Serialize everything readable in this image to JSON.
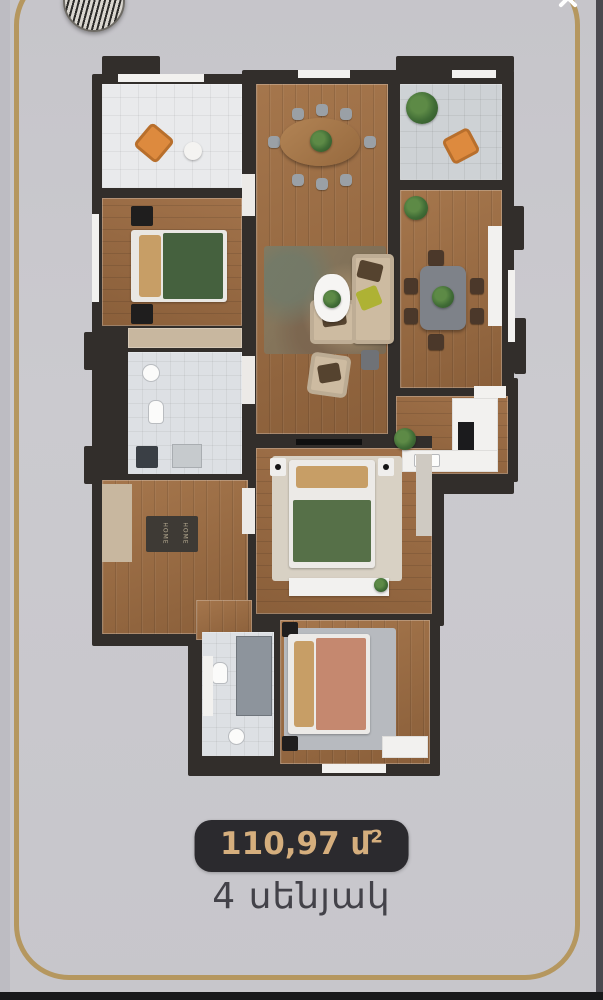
{
  "palette": {
    "bg": "#c9c8cd",
    "bg-edge": "#bdbcc2",
    "frame-gold": "#b5975f",
    "edge-dark": "#4a494f",
    "bottom-bar": "#18181a",
    "wall": "#322e2b",
    "wood": "#9c6e45",
    "tile": "#e9eaec",
    "tile-gray": "#ced2d5",
    "bath-tile": "#dde0e4",
    "accent-orange": "#dd8a3e",
    "bed-green": "#45613e",
    "bed-green2": "#567048",
    "bed-salmon": "#c5886f",
    "pillow-tan": "#c79e66",
    "sofa-beige": "#cdbba1",
    "pillow-brown": "#55432f",
    "pillow-lime": "#aeb234",
    "table-gray": "#7e8289",
    "chair-dark": "#4b382a",
    "chair-gray": "#9aa0a6",
    "rug-light": "#d8d1c4",
    "rug-gray": "#b7babf",
    "wardrobe-tan": "#c8b79f",
    "plant-green": "#3f6b35",
    "badge-bg": "#2b2a2e",
    "badge-text": "#d5ae7d",
    "label-text": "#434249",
    "mat": "#3e3a35",
    "mat-text": "#b7ab92"
  },
  "header": {
    "close_glyph": ""
  },
  "floorplan": {
    "mat_text": "HOME"
  },
  "footer": {
    "area_value": "110,97",
    "area_unit": " մ",
    "area_sup": "2",
    "rooms_label": "4 սենյակ"
  }
}
